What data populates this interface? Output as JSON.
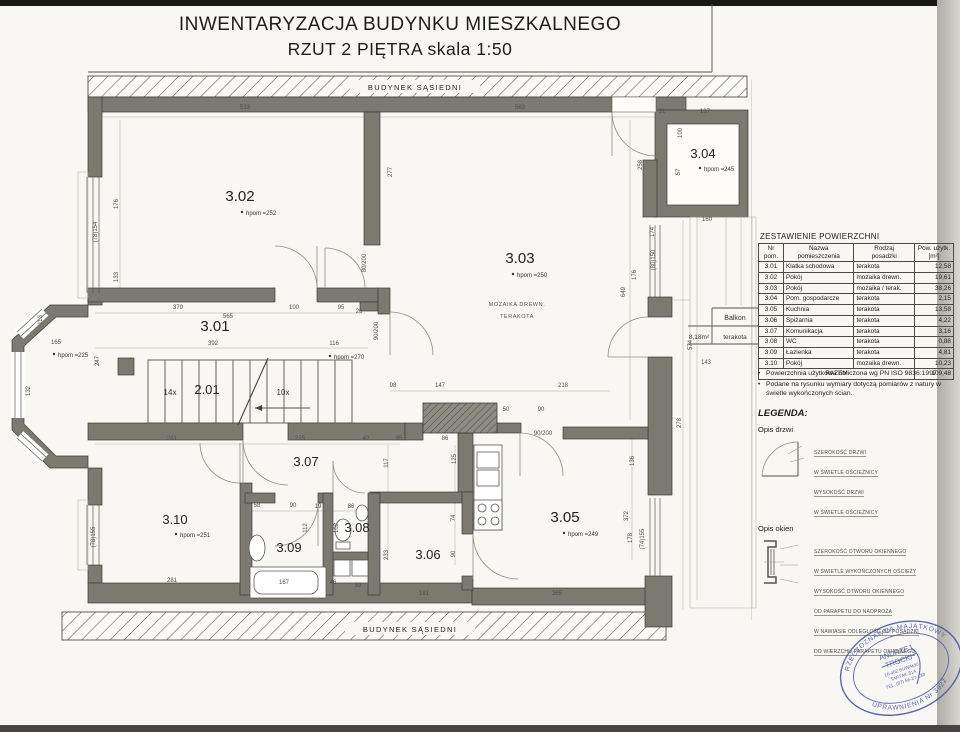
{
  "title": {
    "line1": "INWENTARYZACJA BUDYNKU MIESZKALNEGO",
    "line2": "RZUT 2 PIĘTRA skala 1:50"
  },
  "neighbor": {
    "top": "BUDYNEK SĄSIEDNI",
    "bottom": "BUDYNEK SĄSIEDNI"
  },
  "rooms": [
    {
      "number": "3.01"
    },
    {
      "number": "3.02",
      "height": "hpom =252"
    },
    {
      "number": "3.03",
      "height": "hpom =250",
      "floor_line1": "MOZAIKA DREWN.",
      "floor_line2": "TERAKOTA"
    },
    {
      "number": "3.04",
      "height": "hpom =245"
    },
    {
      "number": "3.05",
      "height": "hpom =249"
    },
    {
      "number": "3.06"
    },
    {
      "number": "3.07"
    },
    {
      "number": "3.08"
    },
    {
      "number": "3.09"
    },
    {
      "number": "3.10",
      "height": "hpom =251"
    }
  ],
  "extra_heights": {
    "corridor": "hpom =270",
    "bay": "hpom =225"
  },
  "stairs": {
    "label": "2.01",
    "flight_up": "14x",
    "flight_down": "10x"
  },
  "balcony": {
    "name": "Balkon",
    "area": "8,18m²",
    "floor": "terakota"
  },
  "area_table": {
    "title": "ZESTAWIENIE POWIERZCHNI",
    "headers": {
      "col1a": "Nr",
      "col1b": "pom.",
      "col2a": "Nazwa",
      "col2b": "pomieszczenia",
      "col3a": "Rodzaj",
      "col3b": "posadzki",
      "col4a": "Pow. użytk.",
      "col4b": "[m²]"
    },
    "rows": [
      [
        "3.01",
        "Klatka schodowa",
        "terakota",
        "12,58"
      ],
      [
        "3.02",
        "Pokój",
        "mozaika drewn.",
        "19,61"
      ],
      [
        "3.03",
        "Pokój",
        "mozaika / terak.",
        "38,26"
      ],
      [
        "3.04",
        "Pom. gospodarcze",
        "terakota",
        "2,15"
      ],
      [
        "3.05",
        "Kuchnia",
        "terakota",
        "13,58"
      ],
      [
        "3.06",
        "Spiżarnia",
        "terakota",
        "4,22"
      ],
      [
        "3.07",
        "Komunikacja",
        "terakota",
        "3,16"
      ],
      [
        "3.08",
        "WC",
        "terakota",
        "0,88"
      ],
      [
        "3.09",
        "Łazienka",
        "terakota",
        "4,81"
      ],
      [
        "3.10",
        "Pokój",
        "mozaika drewn.",
        "10,23"
      ]
    ],
    "total_label": "RAZEM",
    "total_value": "109,48"
  },
  "notes": [
    "Powierzchnia użytkowa obliczona wg PN ISO 9836:1997",
    "Podane na rysunku wymiary dotyczą pomiarów z natury w świetle wykończonych ścian."
  ],
  "legend": {
    "title": "LEGENDA:",
    "doors_title": "Opis drzwi",
    "doors_lines": [
      "SZEROKOŚĆ DRZWI",
      "W ŚWIETLE OŚCIEŻNICY",
      "WYSOKOŚĆ DRZWI",
      "W ŚWIETLE OŚCIEŻNICY"
    ],
    "windows_title": "Opis okien",
    "windows_lines": [
      "SZEROKOŚĆ OTWORU OKIENNEGO",
      "W ŚWIETLE WYKOŃCZONYCH OŚCIEŻY",
      "WYSOKOŚĆ OTWORU OKIENNEGO",
      "OD PARAPETU DO NADPROŻA",
      "W NAWIASIE ODLEGŁOŚĆ OD POSADZKI",
      "DO WIERZCHU PARAPETU OKIENNEGO"
    ]
  },
  "stamp": {
    "ring_top": "RZECZOZNAWCA MAJĄTKOWY",
    "ring_bottom": "UPRAWNIENIA Nr 3922",
    "name1": "ANDRZEJ",
    "name2": "TROCKI",
    "addr1": "16-402 SUWAŁKI",
    "addr2": "TARTAK 31A",
    "addr3": "TEL. (87) 56-27-133"
  },
  "dimensions": [
    "533",
    "563",
    "31",
    "137",
    "176",
    "133",
    "277",
    "100",
    "57",
    "258",
    "160",
    "174",
    "(80)150",
    "176",
    "649",
    "370",
    "100",
    "95",
    "26",
    "565",
    "392",
    "116",
    "165",
    "113",
    "247",
    "132",
    "80/200",
    "90/200",
    "(78)154",
    "281",
    "225",
    "42",
    "98",
    "147",
    "218",
    "50",
    "90",
    "95",
    "86",
    "125",
    "117",
    "58",
    "90",
    "19",
    "86",
    "112",
    "102",
    "(78)155",
    "74",
    "90",
    "233",
    "281",
    "167",
    "46",
    "59",
    "181",
    "365",
    "372",
    "178",
    "136",
    "(74)155",
    "143",
    "574",
    "278",
    "90/200"
  ]
}
